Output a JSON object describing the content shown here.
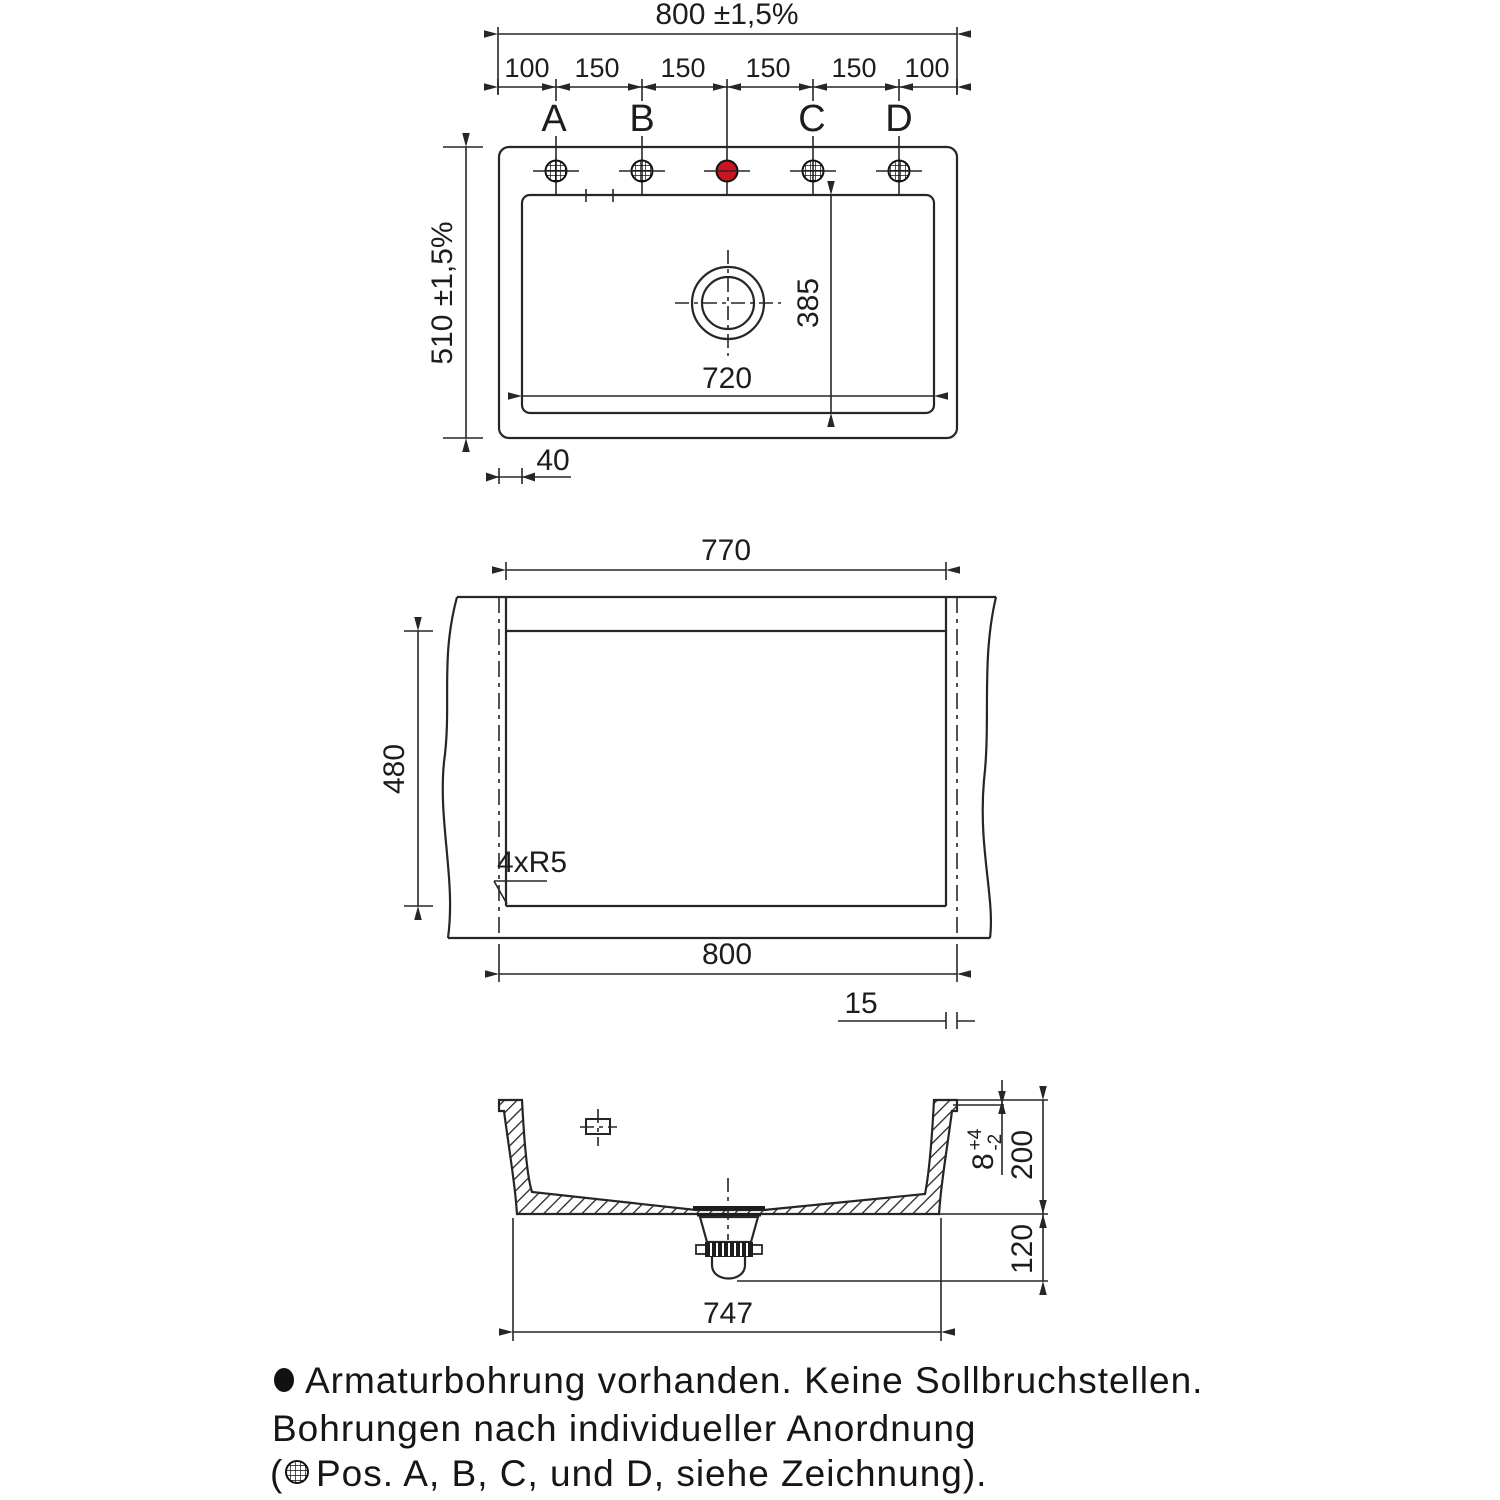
{
  "drawing": {
    "colors": {
      "line": "#262626",
      "accent_red": "#cc1420"
    },
    "top_view": {
      "dim_overall_width": "800 ±1,5%",
      "dim_overall_height": "510 ±1,5%",
      "segments": [
        "100",
        "150",
        "150",
        "150",
        "150",
        "100"
      ],
      "hole_labels": [
        "A",
        "B",
        "C",
        "D"
      ],
      "dim_bowl_width": "720",
      "dim_bowl_depth": "385",
      "dim_edge_offset": "40"
    },
    "cutout_view": {
      "dim_cutout_width": "770",
      "dim_cutout_height": "480",
      "corner_radius_note": "4xR5",
      "dim_outer_width": "800",
      "dim_overhang": "15"
    },
    "section_view": {
      "dim_rim": "8",
      "dim_rim_tol_plus": "+4",
      "dim_rim_tol_minus": "-2",
      "dim_depth": "200",
      "dim_below_bowl": "120",
      "dim_base_width": "747"
    },
    "notes": {
      "line1": "Armaturbohrung vorhanden. Keine Sollbruchstellen.",
      "line2": "Bohrungen nach individueller Anordnung",
      "line3_prefix": "(",
      "line3_body": "Pos. A, B, C, und D, siehe Zeichnung)."
    }
  }
}
